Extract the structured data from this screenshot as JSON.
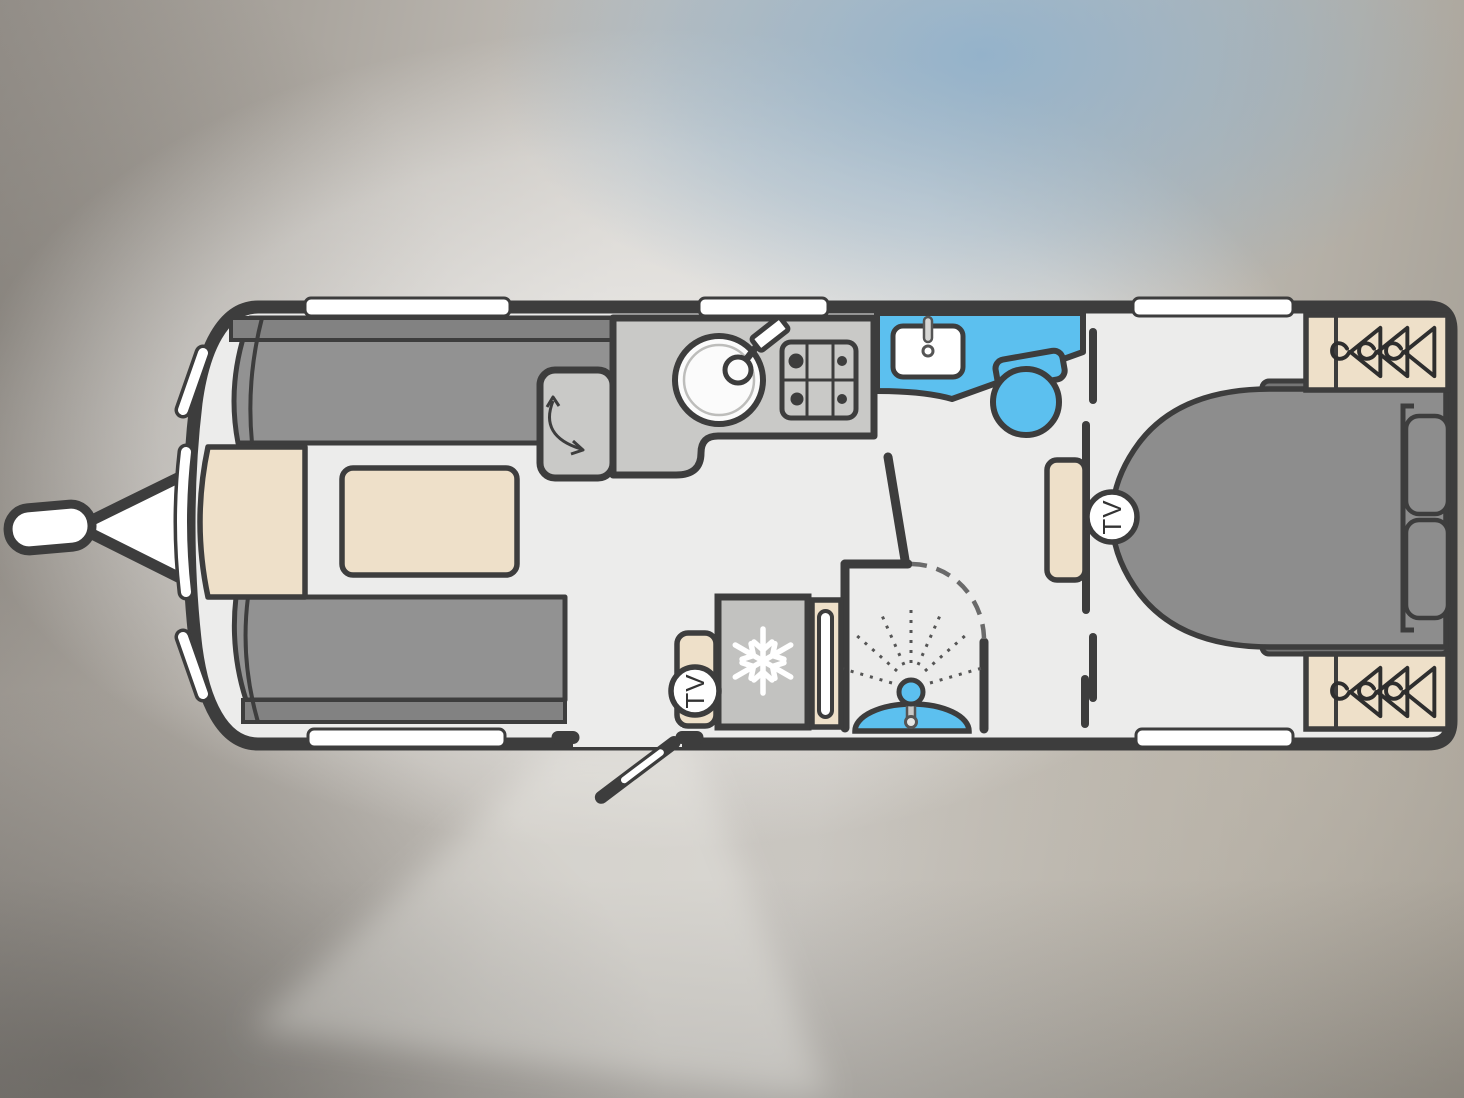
{
  "diagram": {
    "type": "caravan-floorplan-top-view",
    "badges": {
      "tv_lounge": "TV",
      "tv_bedroom": "TV"
    },
    "colors": {
      "outline": "#3d3d3d",
      "floor": "#ececeb",
      "upholstery": "#909090",
      "upholstery_backrest": "#828282",
      "bed": "#8d8d8d",
      "worktop": "#c9c9c7",
      "appliance": "#c2c2c0",
      "cabinetry_wood": "#eee0c9",
      "water_blue": "#5cc0ef",
      "window_white": "#ffffff",
      "background_blue_tint": "#8bafcc"
    },
    "fixtures": [
      "hitch-a-frame",
      "jockey-wheel",
      "front-chest",
      "lounge-sofa-top",
      "lounge-sofa-bottom",
      "pedestal-table",
      "cabinet-with-door-swing",
      "kitchen-worktop",
      "round-sink-with-tap",
      "four-burner-hob",
      "washbasin-vanity",
      "toilet",
      "shower-cubicle",
      "fridge-freezer",
      "tall-slot-cupboard",
      "tv-cabinet",
      "bedside-locker",
      "island-bed-with-pillows",
      "wardrobe-rear-top",
      "wardrobe-rear-bottom",
      "entrance-door-open"
    ],
    "window_counts": {
      "top_wall": 3,
      "bottom_wall": 2,
      "front_curve": 3
    }
  }
}
